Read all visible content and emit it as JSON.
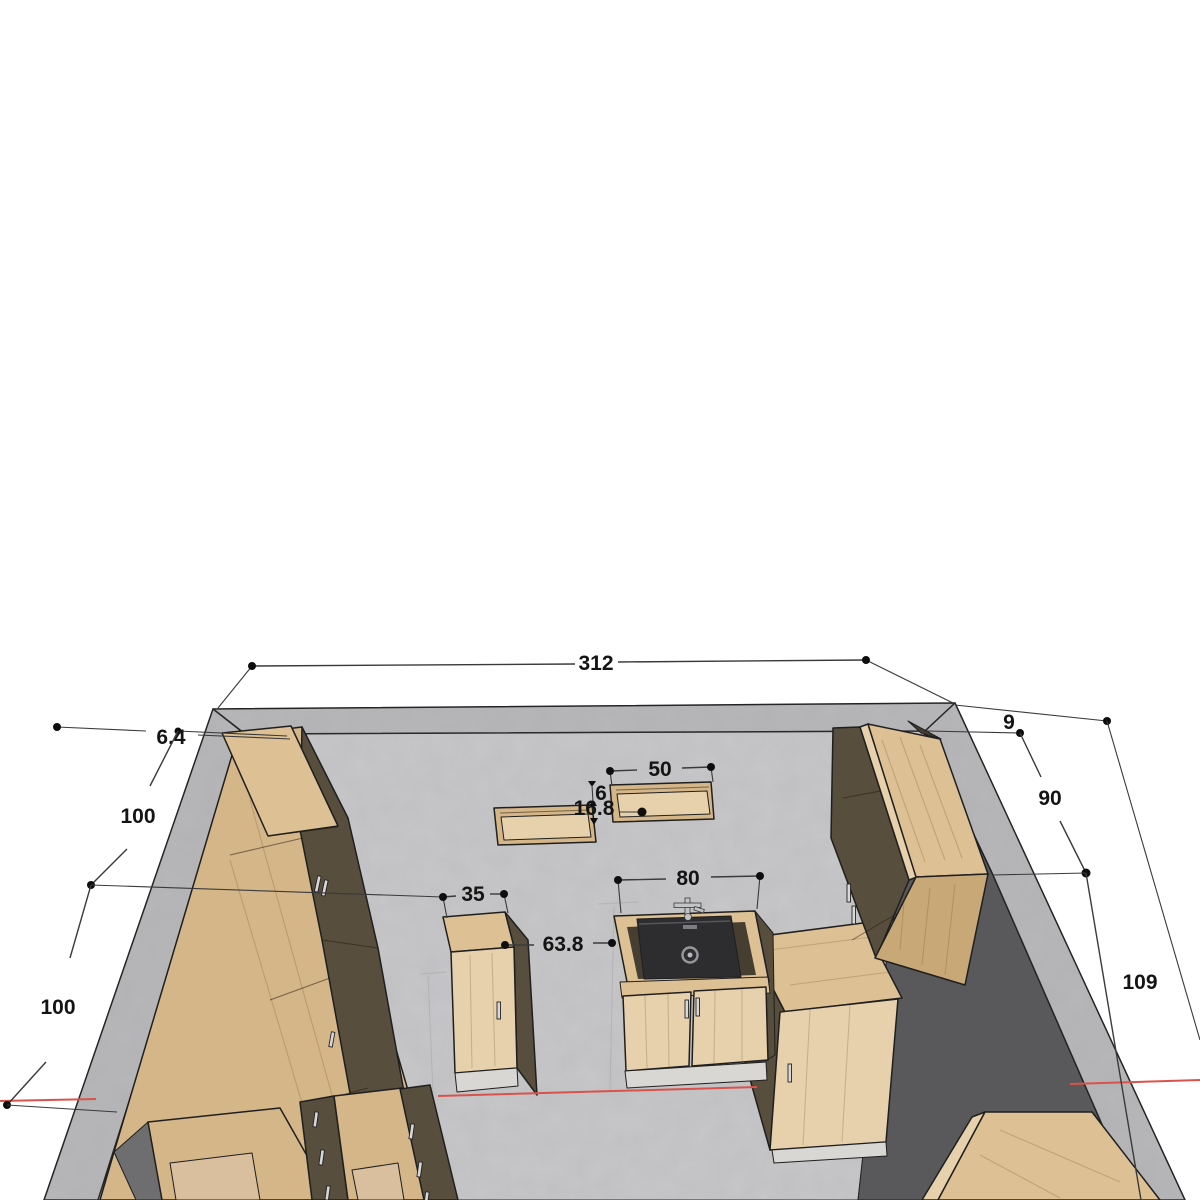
{
  "dimensions": {
    "back_width": "312",
    "left_wall_offset": "6.4",
    "left_run_segment_1": "100",
    "left_run_segment_2": "100",
    "wall_shelf_width": "50",
    "wall_shelf_gap": "6",
    "wall_shelf_depth": "16.8",
    "small_cabinet_width": "35",
    "walkway_gap": "63.8",
    "sink_cabinet_width": "80",
    "right_wall_offset": "9",
    "right_run_segment_1": "90",
    "right_run_segment_2": "109"
  },
  "colors": {
    "floor": "#c7c6c8",
    "wall_top": "#b7b6b8",
    "wall_shadow": "#59595b",
    "wood": "#d5b688",
    "wood_light": "#ddc194",
    "wood_mid": "#c9a878",
    "wood_pale": "#e7d1ac",
    "cabinet_dark": "#574e3d",
    "tan_interior": "#d9bf9e",
    "plinth": "#d9d7d3",
    "sink_black": "#2d2d2f",
    "section_red": "#d9534c",
    "dim_line": "#3a3a3a",
    "dim_text": "#141414"
  }
}
